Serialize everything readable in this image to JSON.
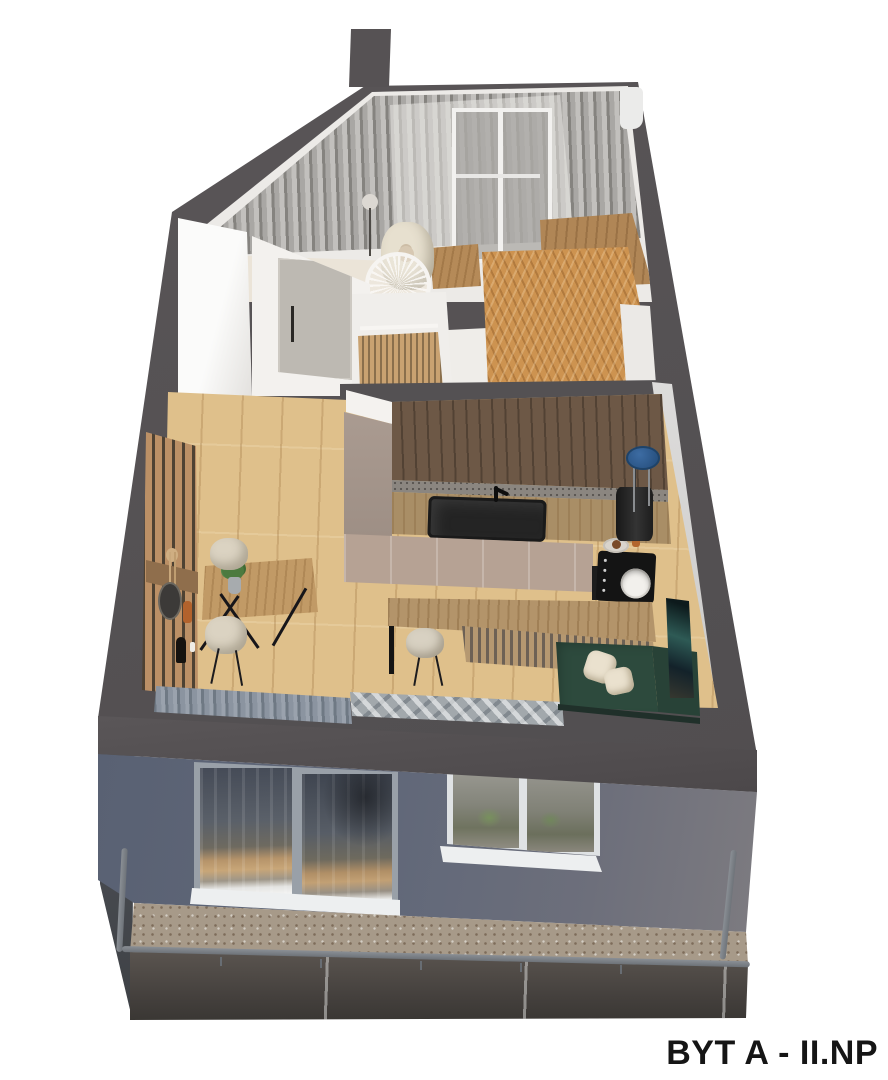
{
  "title": {
    "label": "BYT A - II.NP"
  },
  "scene": {
    "type": "3d-floorplan-render",
    "view": "axonometric-cutaway",
    "objects": [
      "outer-walls",
      "chimney-stub",
      "nursery-with-curtains-window-armchair-crib",
      "wardrobe",
      "interior-door",
      "bathroom-with-slats",
      "entry-hall-herringbone-floor",
      "kitchen-upper-cabinets",
      "kitchen-countertop",
      "black-sink",
      "induction-cooktop",
      "pendant-lamp",
      "blue-stool",
      "base-cabinets",
      "oven",
      "breakfast-bar",
      "bar-stool",
      "green-sofa-with-pillows",
      "leaning-artwork",
      "dining-table-with-plant",
      "two-dining-chairs",
      "wood-slat-accent-wall",
      "console-with-decor",
      "gray-rug",
      "stacked-curtains",
      "building-facade",
      "sliding-glass-door",
      "casement-window",
      "balcony-tile-floor",
      "balcony-railing",
      "balcony-cladding"
    ]
  },
  "palette": {
    "background": "#ffffff",
    "wall_cut": "#565254",
    "facade_blue": "#5e6678",
    "floor_oak": "#dfc08b",
    "floor_herringbone": "#cd9350",
    "kitchen_wood_dark": "#6d5846",
    "cabinet_beige": "#b6a294",
    "sofa_green": "#2d4a3d",
    "stool_blue": "#2e5c90",
    "balcony_tile": "#a79a89",
    "railing_gray": "#7c8187",
    "curtain_gray": "#a9a7a4",
    "title_text": "#151515"
  }
}
